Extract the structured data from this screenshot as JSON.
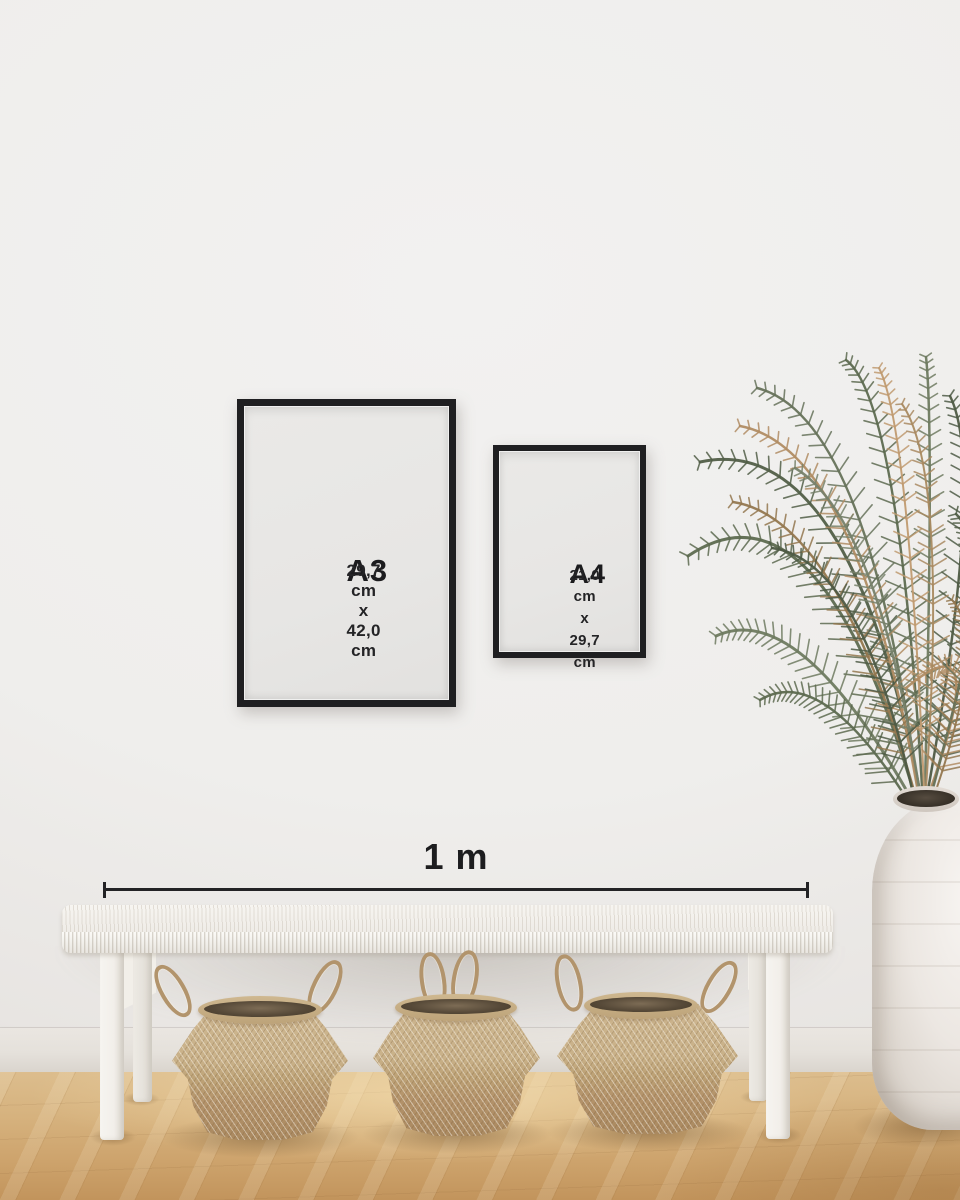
{
  "frames": {
    "a3": {
      "label": "A3",
      "dimensions": "29,7 cm x 42,0 cm"
    },
    "a4": {
      "label": "A4",
      "dimensions_line1": "21,0 cm x",
      "dimensions_line2": "29,7 cm"
    }
  },
  "ruler": {
    "label": "1 m"
  },
  "scene": {
    "objects": [
      "black-poster-frame-a3",
      "black-poster-frame-a4",
      "scale-ruler-1m",
      "white-woven-bench",
      "seagrass-belly-basket",
      "seagrass-belly-basket",
      "seagrass-belly-basket",
      "palm-plant",
      "white-clay-vase",
      "oak-wood-floor"
    ]
  },
  "colors": {
    "frame_border": "#1f1f21",
    "frame_paper": "#e8e7e5",
    "text": "#1c1c1e",
    "wall": "#efeeec",
    "baseboard": "#e5e1db",
    "floor": "#d2ab75",
    "bench": "#f3f1ec",
    "basket": "#c3ab82",
    "plant_green": "#5d6a50",
    "plant_dried": "#b08c63",
    "vase": "#ece7e2"
  }
}
